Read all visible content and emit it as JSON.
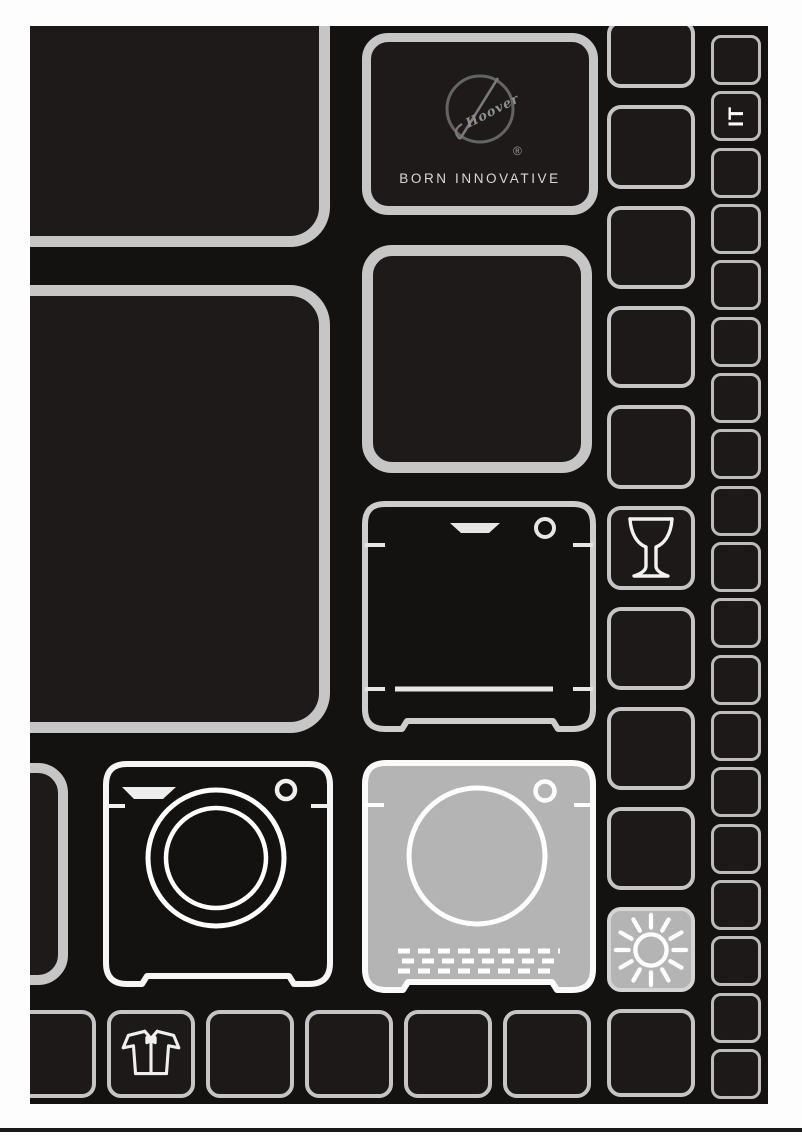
{
  "brand": {
    "name": "Hoover",
    "registered": "®",
    "tagline": "BORN INNOVATIVE"
  },
  "language_badge": "IT",
  "icons": [
    "hoover-logo",
    "wine-glass-icon",
    "sun-icon",
    "washing-machine-icon",
    "tumble-dryer-icon",
    "shirt-icon"
  ],
  "colors": {
    "page_background": "#141111",
    "panel_outline": "#c5c5c5",
    "appliance_outline": "#f5f5f5",
    "filled_square": "#b4b4b4",
    "outside_margin": "#fdfdfd"
  },
  "grid": {
    "right_column_cells": [
      "",
      "IT",
      "",
      "",
      "",
      "",
      "",
      "",
      "",
      "",
      "",
      "",
      "",
      "",
      "",
      "",
      "",
      "",
      ""
    ],
    "program_column_cells": [
      "",
      "",
      "",
      "",
      "",
      "wine-glass-icon",
      "",
      "",
      "",
      "sun-icon",
      ""
    ],
    "bottom_row_cells": [
      "",
      "shirt-icon",
      "",
      "",
      "",
      ""
    ]
  }
}
